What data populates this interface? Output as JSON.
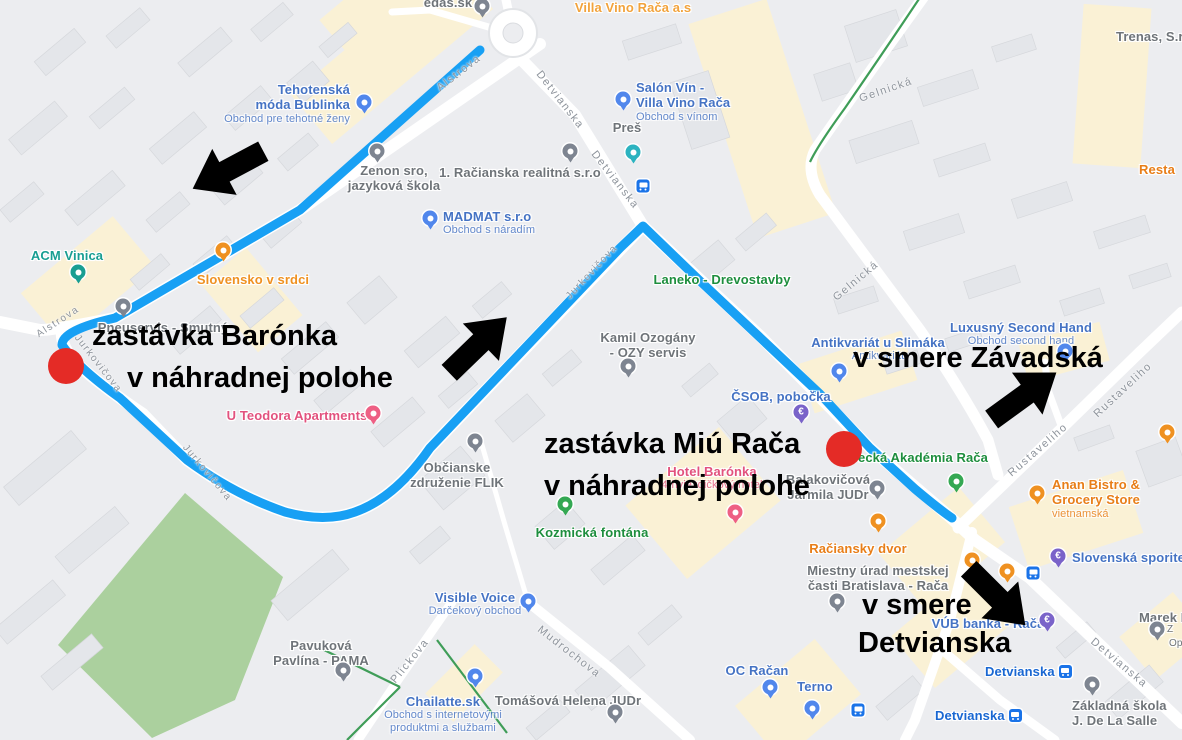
{
  "map": {
    "background": "#ecedf0",
    "road_color": "#ffffff",
    "building_color": "#e4e6ea",
    "commercial_zone_color": "#faf1d5",
    "park_color": "#abd09e",
    "green_path_color": "#3f9d58"
  },
  "overlay": {
    "route_color": "#18a0f4",
    "stop_dot_color": "#e42b26",
    "arrow_color": "#000000",
    "stop1_line1": "zastávka Barónka",
    "stop1_line2": "v náhradnej polohe",
    "stop2_line1": "zastávka Miú Rača",
    "stop2_line2": "v náhradnej polohe",
    "direction1": "v smere Závadská",
    "direction2_line1": "v smere",
    "direction2_line2": "Detvianska"
  },
  "streets": {
    "alstrova": "Alstrova",
    "detvianska": "Detvianska",
    "gelnicka": "Gelnická",
    "jurkovicova": "Jurkovičova",
    "mudrochova": "Mudrochova",
    "plickova": "Plickova",
    "rustaveliho": "Rustaveliho"
  },
  "transit": {
    "bus_stop_name": "Detvianska"
  },
  "pois": {
    "edas": {
      "name": "edas.sk"
    },
    "villa_vino": {
      "name": "Villa Vino Rača a.s"
    },
    "trenas": {
      "name": "Trenas, S.r.o"
    },
    "salon_vin": {
      "line1": "Salón Vín -",
      "line2": "Villa Vino Rača",
      "sub": "Obchod s vínom"
    },
    "pres": {
      "name": "Preš"
    },
    "tehotenska": {
      "line1": "Tehotenská",
      "line2": "móda Bublinka",
      "sub": "Obchod pre tehotné ženy"
    },
    "zenon": {
      "line1": "Zenon sro,",
      "line2": "jazyková škola"
    },
    "racianska_realitna": {
      "name": "1. Račianska realitná s.r.o"
    },
    "madmat": {
      "name": "MADMAT s.r.o",
      "sub": "Obchod s náradím"
    },
    "acm_vinica": {
      "name": "ACM Vinica"
    },
    "slovensko_v_srdci": {
      "name": "Slovensko v srdci"
    },
    "pneuservis": {
      "name": "Pneuservis - Smutný"
    },
    "laneko": {
      "name": "Laneko - Drevostavby"
    },
    "kamil_ozogany": {
      "line1": "Kamil Ozogány",
      "line2": "- OZY servis"
    },
    "antikvariat": {
      "name": "Antikvariát u Slimáka",
      "sub": "Antikvariát"
    },
    "luxusny_second_hand": {
      "name": "Luxusný Second Hand",
      "sub": "Obchod second hand"
    },
    "csob": {
      "name": "ČSOB, pobočka"
    },
    "u_teodora": {
      "name": "U Teodora Apartments"
    },
    "flik": {
      "line1": "Občianske",
      "line2": "združenie FLIK"
    },
    "kozmicka_fontana": {
      "name": "Kozmická fontána"
    },
    "hotel_baronka": {
      "name": "Hotel Barónka",
      "sub": "4-hviezdičkový hotel"
    },
    "akademia_raca": {
      "name": "ecká Akadémia Rača"
    },
    "judr": {
      "line1": "Balakovičová",
      "line2": "Jarmila JUDr"
    },
    "raciansky_dvor": {
      "name": "Račiansky dvor"
    },
    "miestny_urad": {
      "line1": "Miestny úrad mestskej",
      "line2": "časti Bratislava - Rača"
    },
    "anan_bistro": {
      "line1": "Anan Bistro &",
      "line2": "Grocery Store",
      "sub": "vietnamská"
    },
    "sporitelna": {
      "name": "Slovenská sporiteľňa"
    },
    "vub": {
      "name": "VÚB banka - Rača"
    },
    "marek": {
      "name": "Marek P",
      "frag1": "Z",
      "frag2": "Op"
    },
    "zakladna_skola": {
      "line1": "Základná škola",
      "line2": "J. De La Salle"
    },
    "oc_racan": {
      "name": "OC Račan"
    },
    "terno": {
      "name": "Terno"
    },
    "visible_voice": {
      "name": "Visible Voice",
      "sub": "Darčekový obchod"
    },
    "chailatte": {
      "name": "Chailatte.sk",
      "sub1": "Obchod s internetovými",
      "sub2": "produktmi a službami"
    },
    "tomasova": {
      "name": "Tomášová Helena JUDr"
    },
    "pavukova": {
      "line1": "Pavuková",
      "line2": "Pavlína - PAMA"
    },
    "resta": {
      "name": "Resta"
    }
  }
}
